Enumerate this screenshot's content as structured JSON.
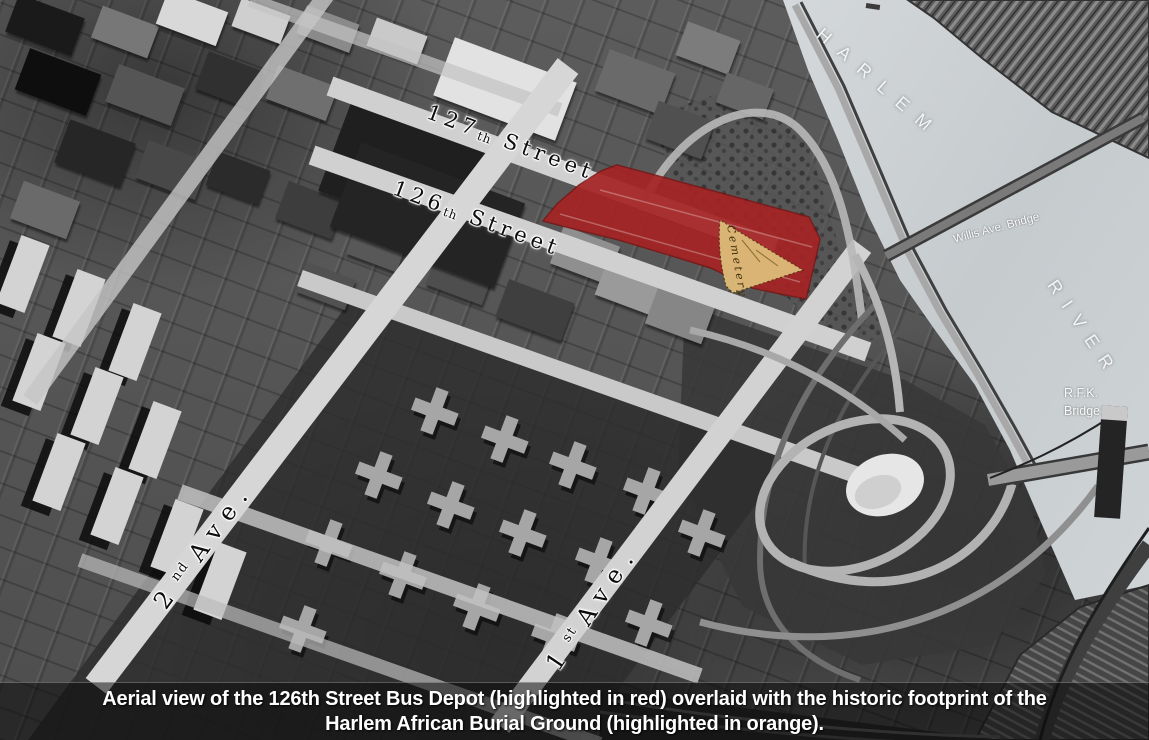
{
  "water": {
    "name_line1": "HARLEM",
    "name_line2": "RIVER"
  },
  "streets": [
    {
      "number": "127",
      "ordinal": "th",
      "word": "Street"
    },
    {
      "number": "126",
      "ordinal": "th",
      "word": "Street"
    }
  ],
  "avenues": [
    {
      "number": "2",
      "ordinal": "nd",
      "word": "Ave."
    },
    {
      "number": "1",
      "ordinal": "st",
      "word": "Ave."
    }
  ],
  "bridges": {
    "willis": "Willis Ave. Bridge",
    "rfk_line1": "R.F.K.",
    "rfk_line2": "Bridge"
  },
  "overlays": {
    "bus_depot": {
      "highlight_color": "#a31414"
    },
    "burial_ground": {
      "label": "Cemetery",
      "highlight_color": "#ddba78"
    }
  },
  "caption": {
    "line1": "Aerial view of the 126th Street Bus Depot (highlighted in red) overlaid with the historic footprint of the",
    "line2": "Harlem African Burial Ground (highlighted in orange)."
  }
}
